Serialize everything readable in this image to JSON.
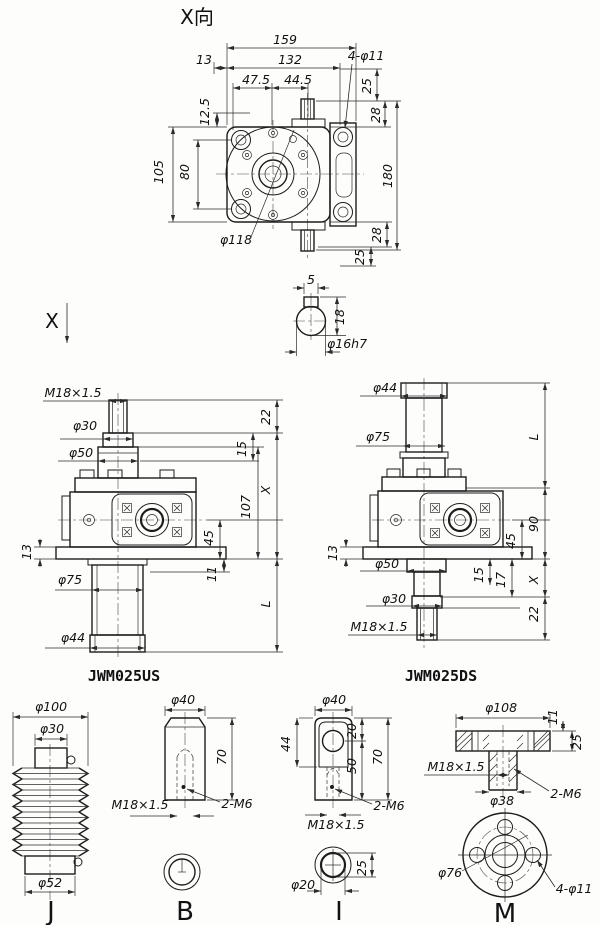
{
  "title": "X向",
  "section_arrow_label": "X",
  "top": {
    "d159": "159",
    "d13": "13",
    "d132": "132",
    "d47_5": "47.5",
    "d44_5": "44.5",
    "holes": "4-φ11",
    "d25_top": "25",
    "d28_top": "28",
    "d12_5": "12.5",
    "d105": "105",
    "d80": "80",
    "d180": "180",
    "phi118": "φ118",
    "d28_bot": "28",
    "d25_bot": "25"
  },
  "shaft": {
    "key_width": "5",
    "depth": "18",
    "dia": "φ16h7"
  },
  "us": {
    "thread": "M18×1.5",
    "phi30": "φ30",
    "phi50": "φ50",
    "d22": "22",
    "d15": "15",
    "dx": "X",
    "d107": "107",
    "d45": "45",
    "d13": "13",
    "d11": "11",
    "phi75": "φ75",
    "dl": "L",
    "phi44": "φ44",
    "name": "JWM025US"
  },
  "ds": {
    "phi44": "φ44",
    "phi75": "φ75",
    "dl": "L",
    "d90": "90",
    "d45": "45",
    "d13": "13",
    "phi50": "φ50",
    "d15": "15",
    "d17": "17",
    "dx": "X",
    "phi30": "φ30",
    "d22": "22",
    "thread": "M18×1.5",
    "name": "JWM025DS"
  },
  "j": {
    "phi100": "φ100",
    "phi30": "φ30",
    "phi52": "φ52",
    "name": "J"
  },
  "b": {
    "phi40": "φ40",
    "d70": "70",
    "thread": "M18×1.5",
    "m6": "2-M6",
    "name": "B"
  },
  "i": {
    "phi40": "φ40",
    "d44": "44",
    "d20": "20",
    "d50": "50",
    "d70": "70",
    "m6": "2-M6",
    "thread": "M18×1.5",
    "d25": "25",
    "phi20": "φ20",
    "name": "I"
  },
  "m": {
    "phi108": "φ108",
    "d11": "11",
    "d25": "25",
    "thread": "M18×1.5",
    "phi38": "φ38",
    "m6": "2-M6",
    "phi76": "φ76",
    "holes": "4-φ11",
    "name": "M"
  }
}
